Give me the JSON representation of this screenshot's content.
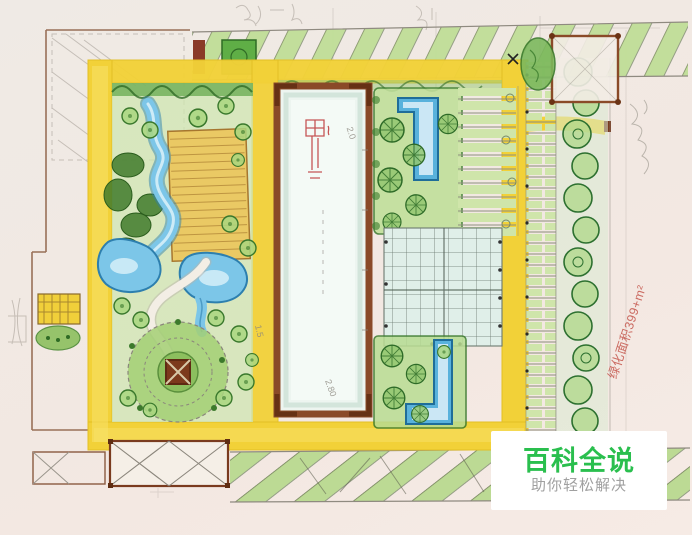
{
  "watermark": {
    "title": "百科全说",
    "subtitle": "助你轻松解决"
  },
  "annotations": {
    "green_area": "绿化面积399+m²",
    "dim_1": "2.0",
    "dim_2": "1.5",
    "dim_3": "2.80"
  },
  "palette": {
    "watermark_green": "#2abf4e",
    "watermark_gray": "#a0a0a0",
    "watermark_bg": "#ffffff",
    "annotation_red": "#c4544a",
    "path_yellow": "#f2d138",
    "water_blue": "#7cc6e8",
    "vegetation_green": "#9ccb6e",
    "building_brown": "#8a4a28",
    "parking_green": "#bfdd97",
    "paper": "#f2e9e3"
  }
}
